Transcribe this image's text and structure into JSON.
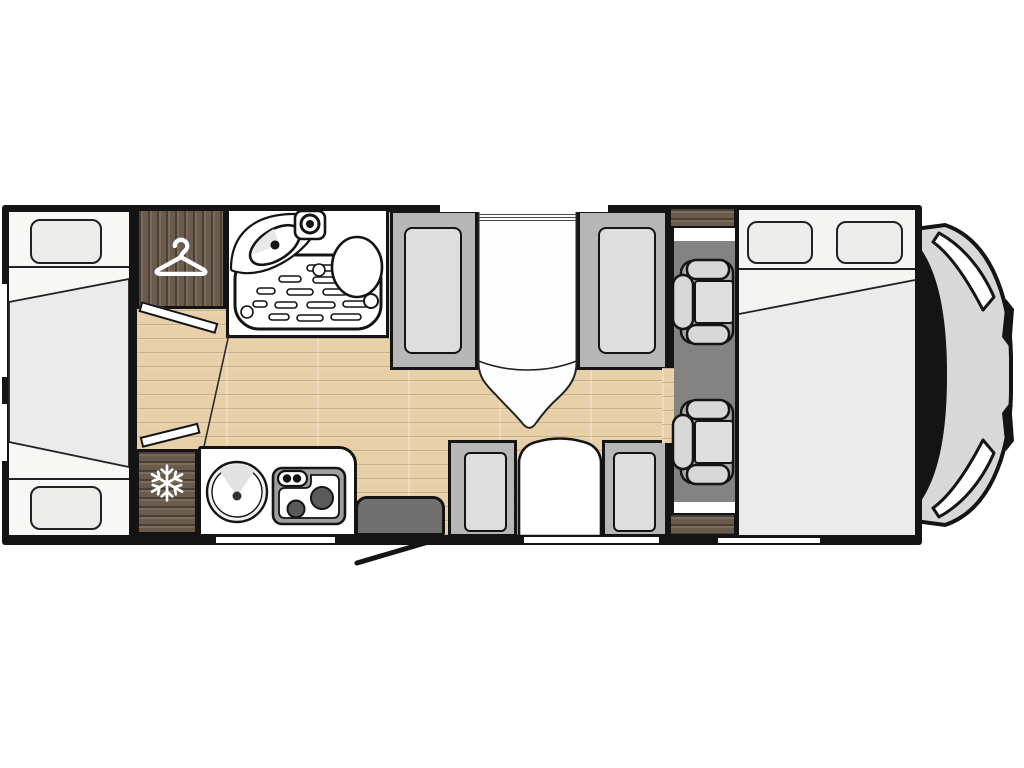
{
  "meta": {
    "title": "Motorhome floor plan (top view)",
    "type": "floorplan-diagram",
    "visible_text": "none"
  },
  "colors": {
    "outline": "#141414",
    "floor_wood": "#e7cfa8",
    "dark_wood": "#6a5b4c",
    "room_white": "#f7f7f5",
    "mattress": "#ebebeb",
    "pillow": "#ececea",
    "cushion": "#dedede",
    "seat_frame": "#b7b7b7",
    "cab_floor": "#838383",
    "cab_seat_base": "#a9a9a9",
    "cab_seat_pad": "#d8d8d8",
    "step": "#6f6f6f",
    "nose_body": "#d8d8d8",
    "stove_frame": "#9f9f9f",
    "burner": "#5a5a5a",
    "window_white": "#ffffff",
    "table_white": "#fdfdfd"
  },
  "rooms": {
    "rear_beds": {
      "label": "Rear twin single beds with center infill mattress"
    },
    "wardrobe": {
      "label": "Wardrobe cabinet"
    },
    "washroom": {
      "label": "Washroom with shower tray, basin and toilet"
    },
    "dinette": {
      "label": "Front dinette: two facing bench seats with table"
    },
    "kitchen": {
      "label": "Kitchen with round sink and two-burner hob"
    },
    "fridge": {
      "label": "Refrigerator cabinet"
    },
    "entry_step": {
      "label": "Entry step with open door swing"
    },
    "side_seats": {
      "label": "Side facing seats with arched table"
    },
    "cab_seats": {
      "label": "Two swivel cab seats"
    },
    "front_bed": {
      "label": "Front double bed with two pillows"
    },
    "cab_front": {
      "label": "Vehicle cab nose with windscreen and headlights"
    }
  },
  "icons": {
    "wardrobe": "hanger-icon",
    "fridge": "snowflake-icon"
  }
}
